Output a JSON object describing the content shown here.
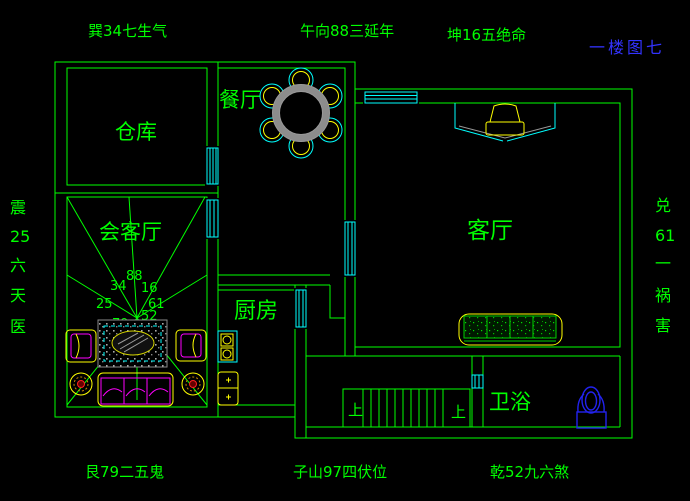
{
  "sheet": {
    "title": "一楼图七"
  },
  "compass": {
    "top_left": "巽34七生气",
    "top_center": "午向88三延年",
    "top_right": "坤16五绝命",
    "bottom_left": "艮79二五鬼",
    "bottom_center": "子山97四伏位",
    "bottom_right": "乾52九六煞",
    "left_vertical": [
      "震",
      "25",
      "六",
      "天",
      "医"
    ],
    "right_vertical": [
      "兑",
      "61",
      "一",
      "祸",
      "害"
    ]
  },
  "rooms": {
    "warehouse": "仓库",
    "dining": "餐厅",
    "reception": "会客厅",
    "kitchen": "厨房",
    "living": "客厅",
    "bath": "卫浴"
  },
  "stairs": {
    "up_label_left": "上",
    "up_label_right": "上"
  },
  "fengshui_numbers": {
    "nw": "34",
    "n": "88",
    "ne": "16",
    "w": "25",
    "e": "61",
    "sw": "79",
    "se": "52"
  },
  "colors": {
    "background": "#000000",
    "wall_green": "#00ff00",
    "window_cyan": "#00ffff",
    "furniture_yellow": "#ffff00",
    "accent_magenta": "#ff00ff",
    "table_gray": "#999999",
    "fixture_blue": "#2222ee",
    "title_blue": "#3333ff"
  }
}
